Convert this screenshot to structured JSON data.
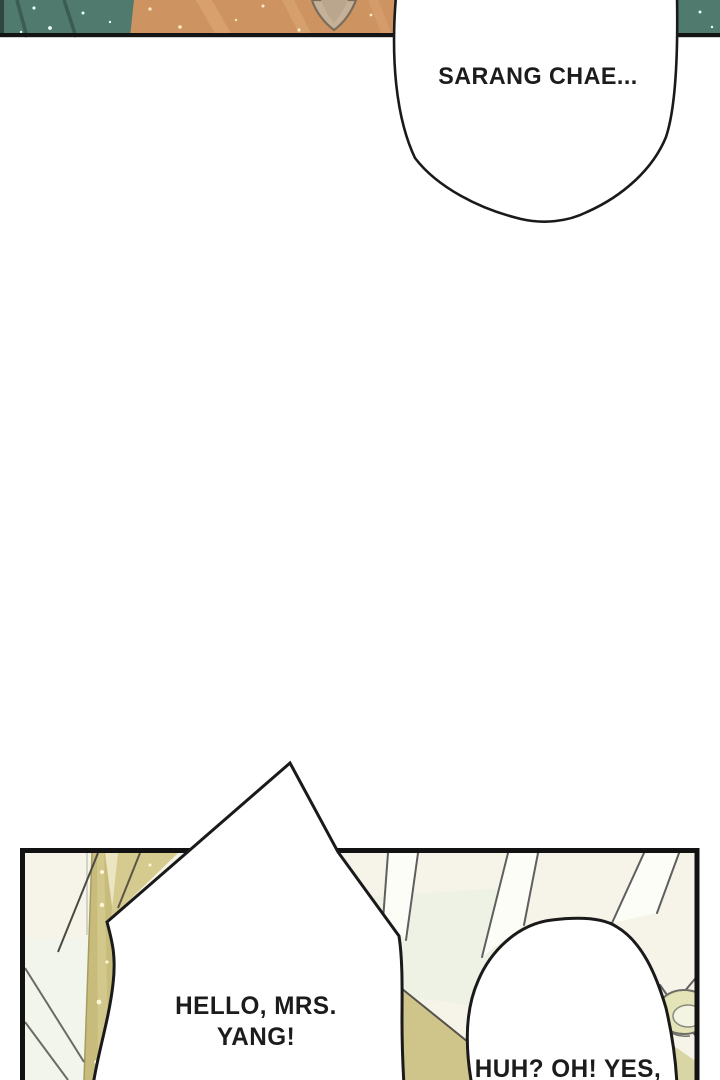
{
  "page": {
    "width": 720,
    "height": 1080,
    "background": "#ffffff"
  },
  "panel_top": {
    "bubble": {
      "text": "SARANG CHAE..."
    },
    "colors": {
      "wall_teal": "#4f7a6d",
      "wall_teal_dark": "#3a5c52",
      "skin_orange": "#cd9462",
      "skin_highlight": "#d8a270",
      "ear_beige": "#c5b098",
      "border_black": "#141414"
    }
  },
  "panel_bottom": {
    "bubble_left": {
      "line1": "HELLO, MRS.",
      "line2": "YANG!"
    },
    "bubble_right": {
      "text": "HUH? OH! YES,"
    },
    "colors": {
      "backdrop_cream": "#f6f3e9",
      "backdrop_green": "#edf2e4",
      "backdrop_white": "#fdfdf8",
      "curtain_olive": "#c8bc7c",
      "curtain_highlight": "#d6cc90",
      "band_cream": "#ece5c2",
      "wedge_khaki": "#d6cb8f",
      "floor_wedge": "#cfc58b",
      "swirl_olive": "#e4e4b8",
      "corner_olive": "#d9d6a6",
      "border_black": "#121212"
    }
  }
}
